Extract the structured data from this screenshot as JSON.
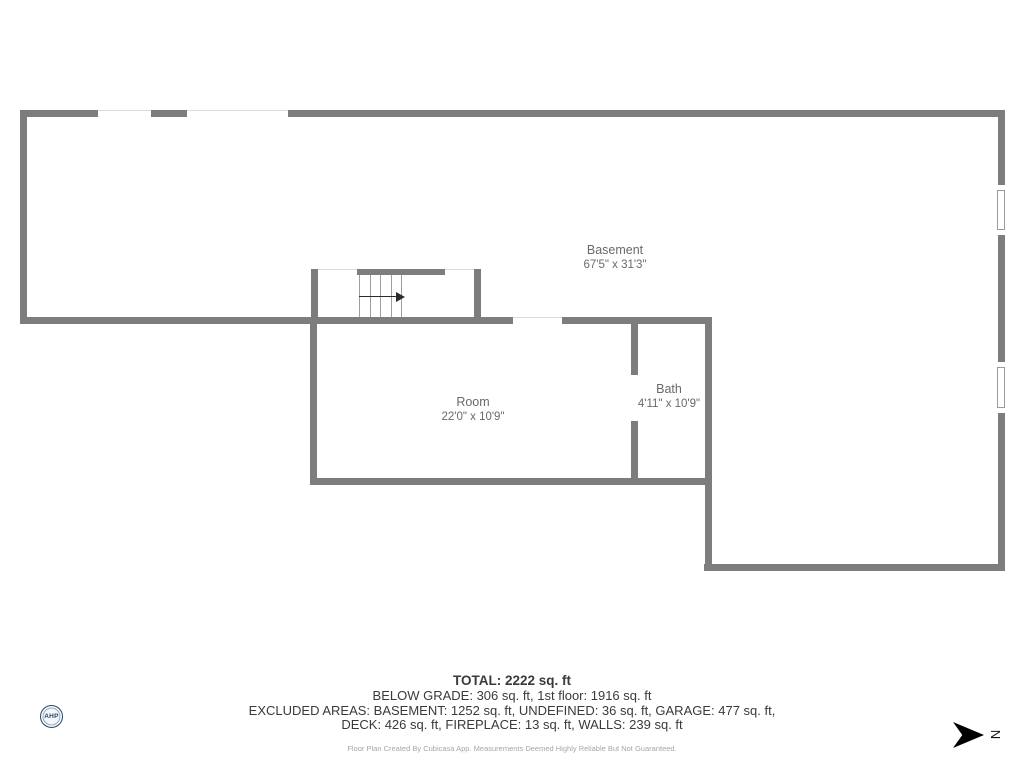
{
  "rooms": [
    {
      "name": "Basement",
      "dims": "67'5\" x 31'3\""
    },
    {
      "name": "Room",
      "dims": "22'0\" x 10'9\""
    },
    {
      "name": "Bath",
      "dims": "4'11\" x 10'9\""
    }
  ],
  "summary": {
    "total": "TOTAL: 2222 sq. ft",
    "line2": "BELOW GRADE: 306 sq. ft, 1st floor: 1916 sq. ft",
    "line3": "EXCLUDED AREAS: BASEMENT: 1252 sq. ft, UNDEFINED: 36 sq. ft, GARAGE: 477 sq. ft,",
    "line4": "DECK: 426 sq. ft, FIREPLACE: 13 sq. ft, WALLS: 239 sq. ft",
    "disclaimer": "Floor Plan Created By Cubicasa App. Measurements Deemed Highly Reliable But Not Guaranteed."
  },
  "compass": {
    "north_label": "N"
  },
  "logo": {
    "text": "AHP"
  },
  "colors": {
    "wall": "#7d7d7d",
    "label": "#696969",
    "text": "#3a3a3a",
    "disclaimer": "#a6a6a6",
    "logo_navy": "#27476b"
  }
}
